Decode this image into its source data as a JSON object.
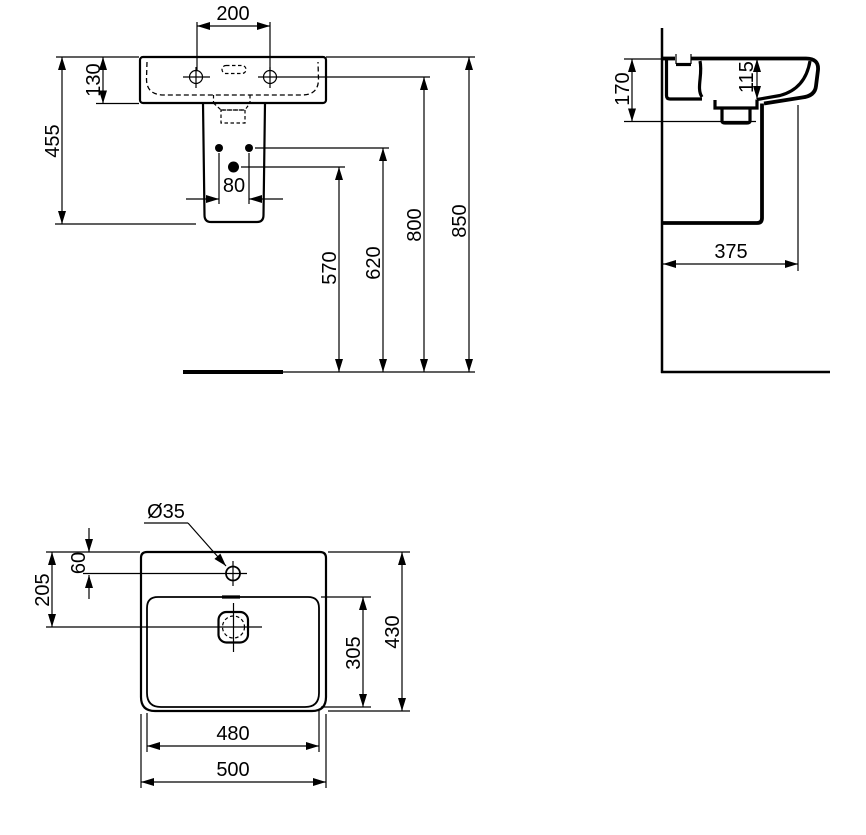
{
  "colors": {
    "ink": "#000000",
    "paper": "#ffffff"
  },
  "views": {
    "front": {
      "name": "front-elevation",
      "dims": {
        "taphole_spacing": "200",
        "rim_to_basin_bottom": "130",
        "rim_to_pedestal_bottom": "455",
        "fixing_hole_spacing": "80",
        "floor_to_drain": "570",
        "floor_to_fixing_holes": "620",
        "floor_to_tapholes": "800",
        "floor_to_rim": "850"
      }
    },
    "side": {
      "name": "side-section",
      "dims": {
        "rim_to_underside": "170",
        "rim_to_bowl_bottom": "115",
        "wall_to_front": "375"
      }
    },
    "plan": {
      "name": "plan-view",
      "dims": {
        "taphole_diameter": "Ø35",
        "edge_to_taphole": "60",
        "edge_to_drain": "205",
        "bowl_front_to_back": "305",
        "overall_depth": "430",
        "bowl_width": "480",
        "overall_width": "500"
      }
    }
  }
}
